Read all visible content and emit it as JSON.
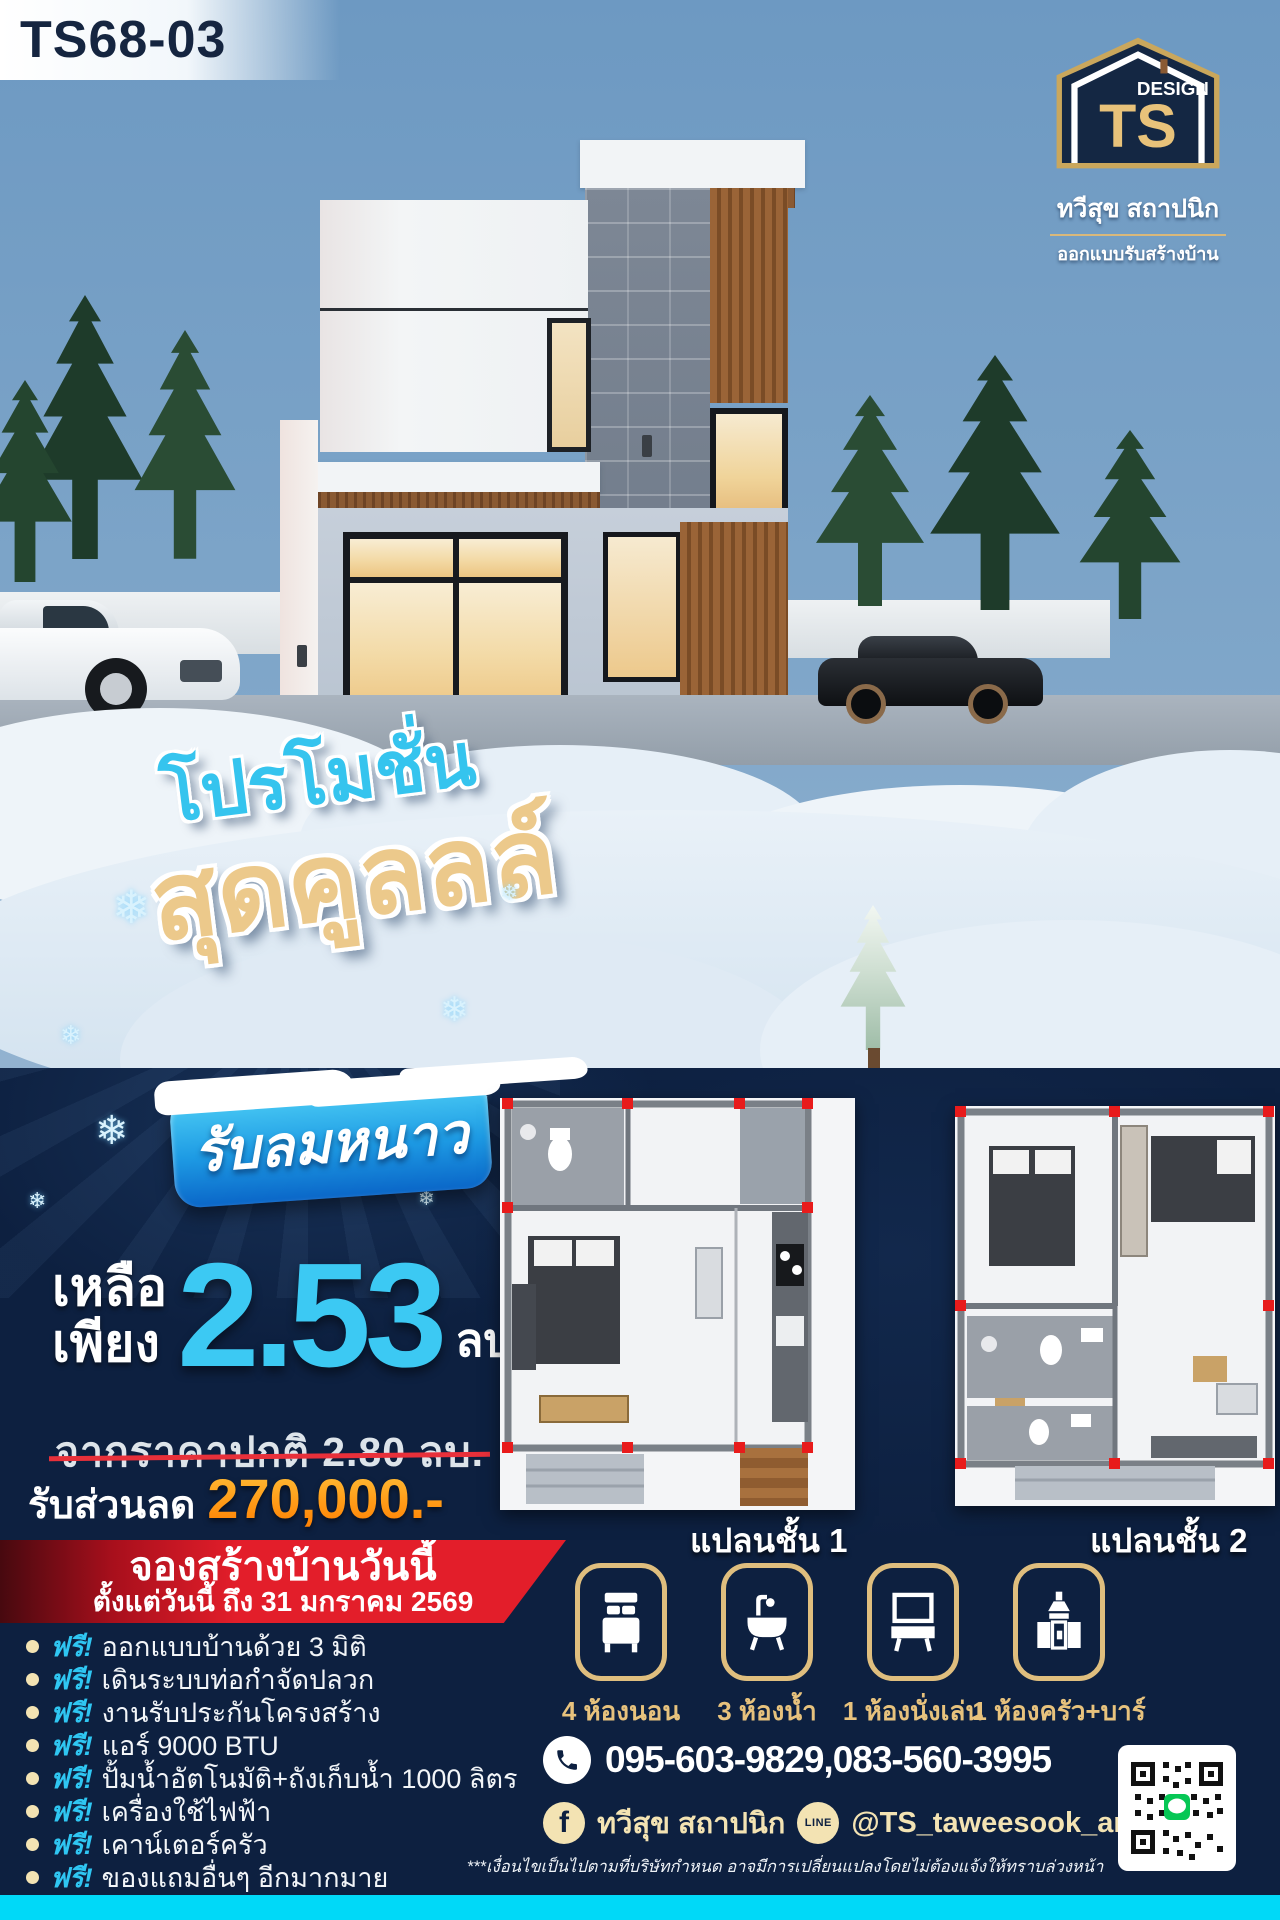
{
  "badge": {
    "code": "TS68-03"
  },
  "logo": {
    "design": "DESIGN",
    "ts": "TS",
    "company": "ทวีสุข สถาปนิก",
    "tagline": "ออกแบบรับสร้างบ้าน"
  },
  "promo": {
    "line1": "โปรโมชั่น",
    "line2": "สุดคูลลล์",
    "badge": "รับลมหนาว"
  },
  "price": {
    "remain_line1": "เหลือ",
    "remain_line2": "เพียง",
    "value": "2.53",
    "unit": "ลบ.",
    "old_price": "จากราคาปกติ 2.80 ลบ.",
    "discount_label": "รับส่วนลด",
    "discount_value": "270,000.-"
  },
  "booking": {
    "title": "จองสร้างบ้านวันนี้",
    "subtitle": "ตั้งแต่วันนี้ ถึง 31 มกราคม 2569"
  },
  "freebies": {
    "free_label": "ฟรี!",
    "items": [
      "ออกแบบบ้านด้วย 3 มิติ",
      "เดินระบบท่อกำจัดปลวก",
      "งานรับประกันโครงสร้าง",
      "แอร์ 9000 BTU",
      "ปั้มน้ำอัตโนมัติ+ถังเก็บน้ำ 1000 ลิตร",
      "เครื่องใช้ไฟฟ้า",
      "เคาน์เตอร์ครัว",
      "ของแถมอื่นๆ อีกมากมาย"
    ]
  },
  "plans": [
    {
      "label": "แปลนชั้น 1"
    },
    {
      "label": "แปลนชั้น 2"
    }
  ],
  "features": [
    {
      "icon": "bed-icon",
      "label": "4 ห้องนอน"
    },
    {
      "icon": "bath-icon",
      "label": "3 ห้องน้ำ"
    },
    {
      "icon": "living-room-icon",
      "label": "1 ห้องนั่งเล่น"
    },
    {
      "icon": "kitchen-icon",
      "label": "1 ห้องครัว+บาร์"
    }
  ],
  "contact": {
    "phone": "095-603-9829,083-560-3995",
    "facebook": "ทวีสุข สถาปนิก",
    "line_label": "LINE",
    "line": "@TS_taweesook_arch",
    "disclaimer": "***เงื่อนไขเป็นไปตามที่บริษัทกำหนด อาจมีการเปลี่ยนแปลงโดยไม่ต้องแจ้งให้ทราบล่วงหน้า"
  },
  "colors": {
    "navy": "#0d2040",
    "cyan_accent": "#3cc9f3",
    "cyan_bar": "#00d9f8",
    "gold": "#e7c27d",
    "cream": "#f3e3b3",
    "red_banner": "#e31e2a",
    "orange_discount": "#ff9c18"
  }
}
